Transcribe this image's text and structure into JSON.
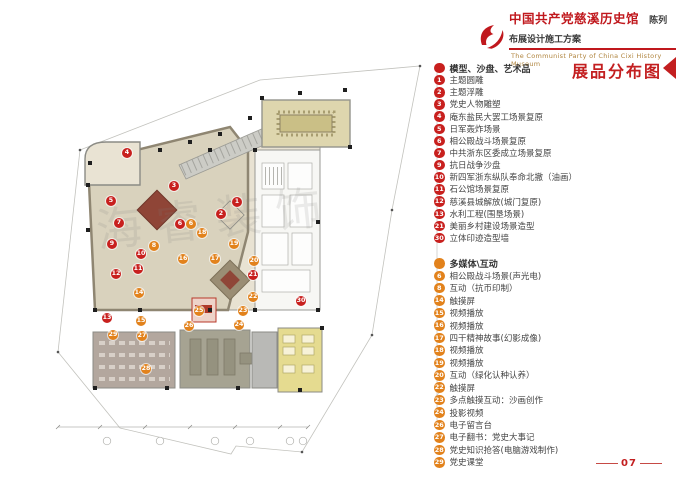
{
  "header": {
    "title_cn": "中国共产党慈溪历史馆",
    "subtitle_cn": "陈列布展设计施工方案",
    "title_en": "The Communist Party of China Cixi History Museum",
    "logo_icon": "party-emblem-flag",
    "brand_red": "#c0181d"
  },
  "legend": {
    "title": "展品分布图",
    "accent_red": "#c8201e",
    "accent_orange": "#e2821c",
    "sections": [
      {
        "header": "模型、沙盘、艺术品",
        "color": "#c8201e",
        "items": [
          {
            "num": "1",
            "label": "主题圆雕"
          },
          {
            "num": "2",
            "label": "主题浮雕"
          },
          {
            "num": "3",
            "label": "党史人物雕塑"
          },
          {
            "num": "4",
            "label": "庵东盐民大罢工场景复原"
          },
          {
            "num": "5",
            "label": "日军轰炸场景"
          },
          {
            "num": "6",
            "label": "相公殿战斗场景复原"
          },
          {
            "num": "7",
            "label": "中共浙东区委成立场景复原"
          },
          {
            "num": "9",
            "label": "抗日战争沙盘"
          },
          {
            "num": "10",
            "label": "新四军浙东纵队奉命北撤（油画）"
          },
          {
            "num": "11",
            "label": "石公馆场景复原"
          },
          {
            "num": "12",
            "label": "慈溪县城解放(城门复原)"
          },
          {
            "num": "13",
            "label": "水利工程(围垦场景)"
          },
          {
            "num": "21",
            "label": "美丽乡村建设场景造型"
          },
          {
            "num": "30",
            "label": "立体印迹造型墙"
          }
        ]
      },
      {
        "header": "多媒体\\互动",
        "color": "#e2821c",
        "items": [
          {
            "num": "6",
            "label": "相公殿战斗场景(声光电)"
          },
          {
            "num": "8",
            "label": "互动（抗币印制）"
          },
          {
            "num": "14",
            "label": "触摸屏"
          },
          {
            "num": "15",
            "label": "视频播放"
          },
          {
            "num": "16",
            "label": "视频播放"
          },
          {
            "num": "17",
            "label": "四干精神故事(幻影成像)"
          },
          {
            "num": "18",
            "label": "视频播放"
          },
          {
            "num": "19",
            "label": "视频播放"
          },
          {
            "num": "20",
            "label": "互动（绿化认种认养）"
          },
          {
            "num": "22",
            "label": "触摸屏"
          },
          {
            "num": "23",
            "label": "多点触摸互动：沙画创作"
          },
          {
            "num": "24",
            "label": "投影视频"
          },
          {
            "num": "26",
            "label": "电子留言台"
          },
          {
            "num": "27",
            "label": "电子翻书：党史大事记"
          },
          {
            "num": "28",
            "label": "党史知识抢答(电脑游戏制作)"
          },
          {
            "num": "29",
            "label": "党史课堂"
          }
        ]
      }
    ]
  },
  "plan": {
    "watermark": "海睿装饰",
    "marker_colors": {
      "red": "#c8201e",
      "orange": "#e2821c"
    },
    "markers": [
      {
        "num": "1",
        "color": "red",
        "x": 237,
        "y": 202
      },
      {
        "num": "2",
        "color": "red",
        "x": 221,
        "y": 214
      },
      {
        "num": "3",
        "color": "red",
        "x": 174,
        "y": 186
      },
      {
        "num": "4",
        "color": "red",
        "x": 127,
        "y": 153
      },
      {
        "num": "5",
        "color": "red",
        "x": 111,
        "y": 201
      },
      {
        "num": "6",
        "color": "red",
        "x": 180,
        "y": 224
      },
      {
        "num": "6",
        "color": "orange",
        "x": 191,
        "y": 224
      },
      {
        "num": "7",
        "color": "red",
        "x": 119,
        "y": 223
      },
      {
        "num": "8",
        "color": "orange",
        "x": 154,
        "y": 246
      },
      {
        "num": "9",
        "color": "red",
        "x": 112,
        "y": 244
      },
      {
        "num": "10",
        "color": "red",
        "x": 141,
        "y": 254
      },
      {
        "num": "11",
        "color": "red",
        "x": 138,
        "y": 269
      },
      {
        "num": "12",
        "color": "red",
        "x": 116,
        "y": 274
      },
      {
        "num": "13",
        "color": "red",
        "x": 107,
        "y": 318
      },
      {
        "num": "14",
        "color": "orange",
        "x": 139,
        "y": 293
      },
      {
        "num": "15",
        "color": "orange",
        "x": 141,
        "y": 321
      },
      {
        "num": "16",
        "color": "orange",
        "x": 183,
        "y": 259
      },
      {
        "num": "17",
        "color": "orange",
        "x": 215,
        "y": 259
      },
      {
        "num": "18",
        "color": "orange",
        "x": 202,
        "y": 233
      },
      {
        "num": "19",
        "color": "orange",
        "x": 234,
        "y": 244
      },
      {
        "num": "20",
        "color": "orange",
        "x": 254,
        "y": 261
      },
      {
        "num": "21",
        "color": "red",
        "x": 253,
        "y": 275
      },
      {
        "num": "22",
        "color": "orange",
        "x": 253,
        "y": 297
      },
      {
        "num": "23",
        "color": "orange",
        "x": 243,
        "y": 311
      },
      {
        "num": "24",
        "color": "orange",
        "x": 239,
        "y": 325
      },
      {
        "num": "25",
        "color": "orange",
        "x": 199,
        "y": 311
      },
      {
        "num": "26",
        "color": "orange",
        "x": 189,
        "y": 326
      },
      {
        "num": "27",
        "color": "orange",
        "x": 142,
        "y": 336
      },
      {
        "num": "28",
        "color": "orange",
        "x": 146,
        "y": 369
      },
      {
        "num": "29",
        "color": "orange",
        "x": 113,
        "y": 335
      },
      {
        "num": "30",
        "color": "red",
        "x": 301,
        "y": 301
      }
    ]
  },
  "footer": {
    "page_number": "07"
  }
}
